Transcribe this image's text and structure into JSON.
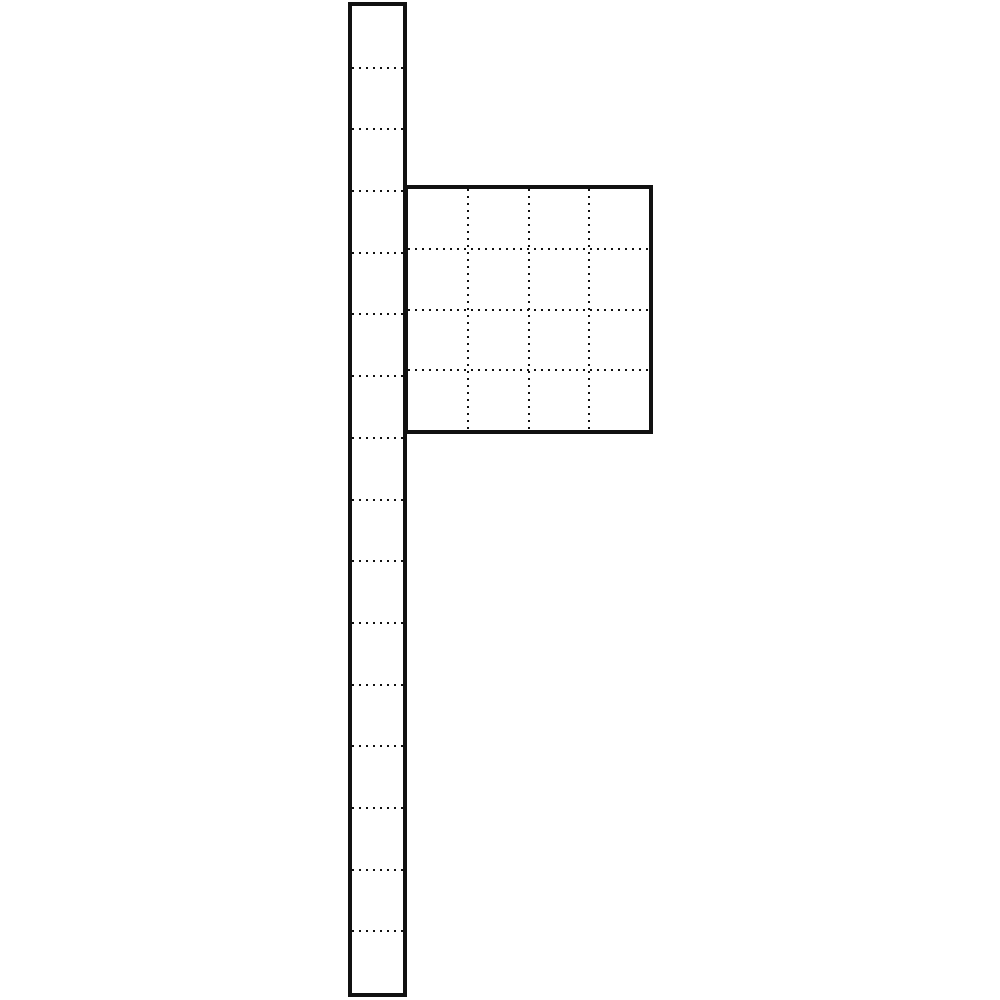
{
  "figure": {
    "description": "technical line drawing: tall segmented post with attached square grid panel",
    "background_color": "#ffffff",
    "line_color": "#111111",
    "post": {
      "x": 348,
      "y": 2,
      "width": 59,
      "height": 995,
      "border_px": 4,
      "segment_count": 16,
      "division_line_count": 15,
      "division_line_style": "dotted"
    },
    "panel": {
      "x": 404,
      "y": 185,
      "width": 249,
      "height": 249,
      "border_px": 4,
      "grid_cols": 4,
      "grid_rows": 4,
      "grid_line_style": "dotted"
    }
  }
}
